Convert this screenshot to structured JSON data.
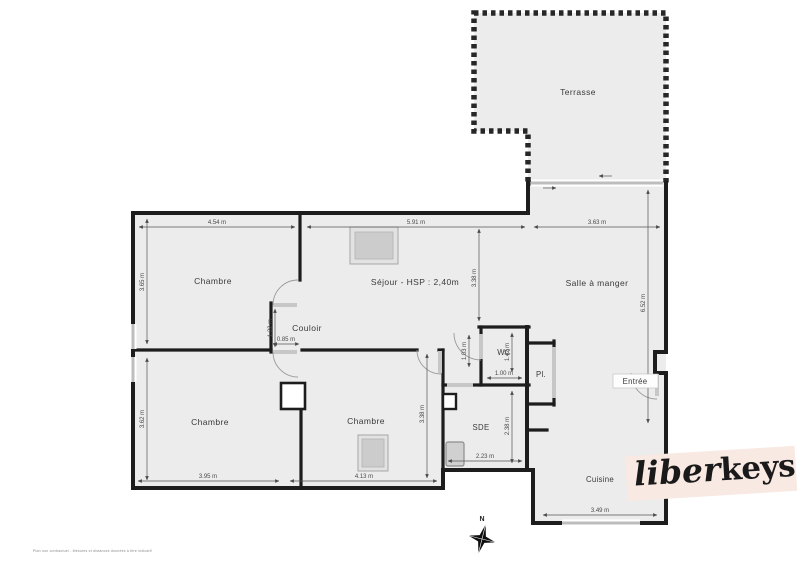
{
  "plan": {
    "colors": {
      "floor": "#ececec",
      "wall": "#1d1d1d",
      "window": "#bdbdbd",
      "logo_band": "#f8e9e2",
      "logo_text": "#1a1a1a"
    },
    "rooms": {
      "terrasse": {
        "label": "Terrasse"
      },
      "chambre1": {
        "label": "Chambre",
        "dim_w": "4.54 m",
        "dim_h": "3.65 m"
      },
      "sejour": {
        "label": "Séjour - HSP : 2,40m",
        "dim_w": "5.91 m",
        "dim_h": "3.38 m"
      },
      "salle_a_manger": {
        "label": "Salle à manger",
        "dim_w": "3.63 m",
        "dim_h": "6.52 m"
      },
      "couloir": {
        "label": "Couloir",
        "dim_w": "0.85 m",
        "dim_h": "1.22 m"
      },
      "chambre2": {
        "label": "Chambre",
        "dim_w": "3.95 m",
        "dim_h": "3.62 m"
      },
      "chambre3": {
        "label": "Chambre",
        "dim_w": "4.13 m",
        "dim_h": "3.38 m"
      },
      "wc": {
        "label": "WC",
        "dim_w": "1.00 m",
        "dim_h": "1.42 m",
        "dim_entry": "1.03 m"
      },
      "sde": {
        "label": "SDE",
        "dim_w": "2.23 m",
        "dim_h": "2.38 m"
      },
      "placard": {
        "label": "Pl."
      },
      "entree": {
        "label": "Entrée"
      },
      "cuisine": {
        "label": "Cuisine",
        "dim_w": "3.49 m"
      }
    },
    "compass": {
      "label": "N"
    },
    "logo": {
      "script": "liber",
      "bold": "keys"
    },
    "footer_note": "Plan non contractuel - Mesures et distances données à titre indicatif"
  }
}
